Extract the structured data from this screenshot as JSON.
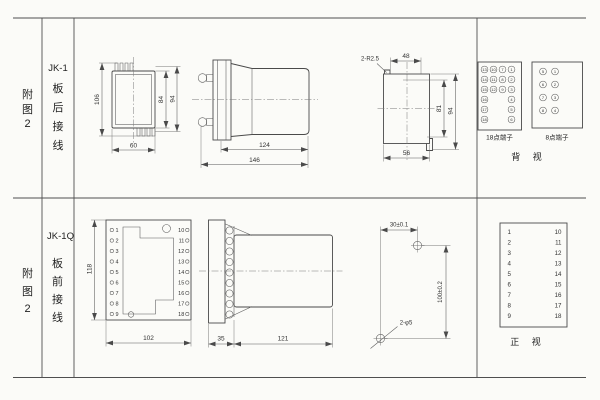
{
  "r1": {
    "index": [
      "附",
      "图",
      "2"
    ],
    "model": "JK-1",
    "wiring": [
      "板",
      "后",
      "接",
      "线"
    ],
    "front": {
      "h_overall": "106",
      "h_body": "84",
      "h_mid": "94",
      "w_body": "60"
    },
    "side": {
      "d_body": "124",
      "d_overall": "146"
    },
    "cutout": {
      "note": "2-R2.5",
      "w_top": "48",
      "h_inner": "81",
      "h_outer": "94",
      "w_bottom": "56"
    },
    "terms": {
      "label18": "18点端子",
      "label8": "8点端子",
      "view": "背 视",
      "t18c1": [
        "13",
        "14",
        "15",
        "16",
        "17",
        "18"
      ],
      "t18c2": [
        "10",
        "11",
        "12"
      ],
      "t18c3": [
        "7",
        "8",
        "9"
      ],
      "t18c4": [
        "1",
        "2",
        "3",
        "4",
        "5",
        "6"
      ],
      "t8l": [
        "5",
        "6",
        "7",
        "8"
      ],
      "t8r": [
        "1",
        "2",
        "3",
        "4"
      ]
    }
  },
  "r2": {
    "index": [
      "附",
      "图",
      "2"
    ],
    "model": "JK-1Q",
    "wiring": [
      "板",
      "前",
      "接",
      "线"
    ],
    "front": {
      "h": "118",
      "w": "102",
      "left": [
        "1",
        "2",
        "3",
        "4",
        "5",
        "6",
        "7",
        "8",
        "9"
      ],
      "right": [
        "10",
        "11",
        "12",
        "13",
        "14",
        "15",
        "16",
        "17",
        "18"
      ]
    },
    "side": {
      "d_flange": "35",
      "d_body": "121"
    },
    "drill": {
      "dx": "30±0.1",
      "dy": "100±0.2",
      "note": "2-φ5"
    },
    "table": {
      "view": "正 视",
      "left": [
        "1",
        "2",
        "3",
        "4",
        "5",
        "6",
        "7",
        "8",
        "9"
      ],
      "right": [
        "10",
        "11",
        "12",
        "13",
        "14",
        "15",
        "16",
        "17",
        "18"
      ]
    }
  }
}
